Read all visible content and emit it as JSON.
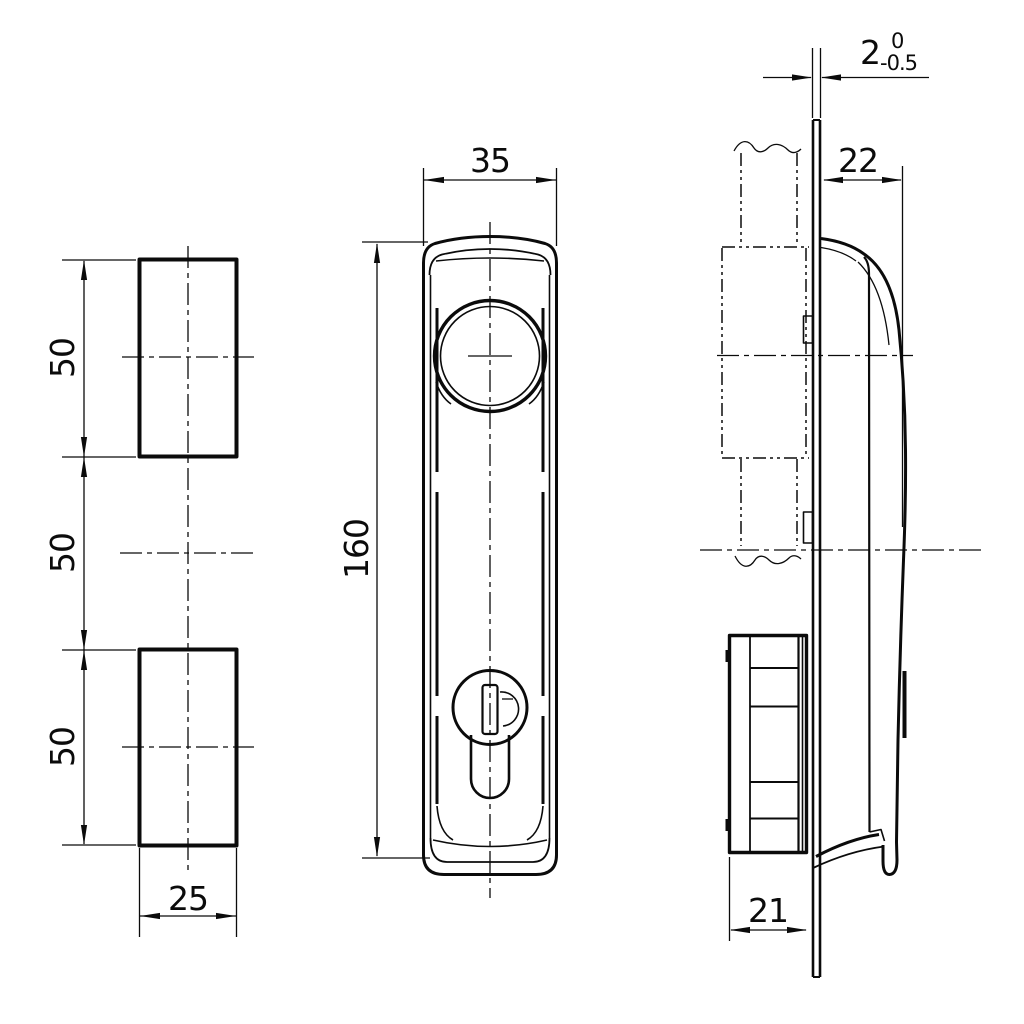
{
  "colors": {
    "line": "#0b0b0b",
    "background": "#ffffff"
  },
  "views": {
    "left": {
      "dims": {
        "segment_top": "50",
        "segment_middle": "50",
        "segment_bottom": "50",
        "width": "25"
      }
    },
    "front": {
      "dims": {
        "width": "35",
        "height": "160"
      }
    },
    "side": {
      "dims": {
        "handle_depth": "22",
        "case_depth": "21",
        "panel_thickness": {
          "nominal": "2",
          "upper_tol": "0",
          "lower_tol": "-0.5"
        }
      }
    }
  }
}
